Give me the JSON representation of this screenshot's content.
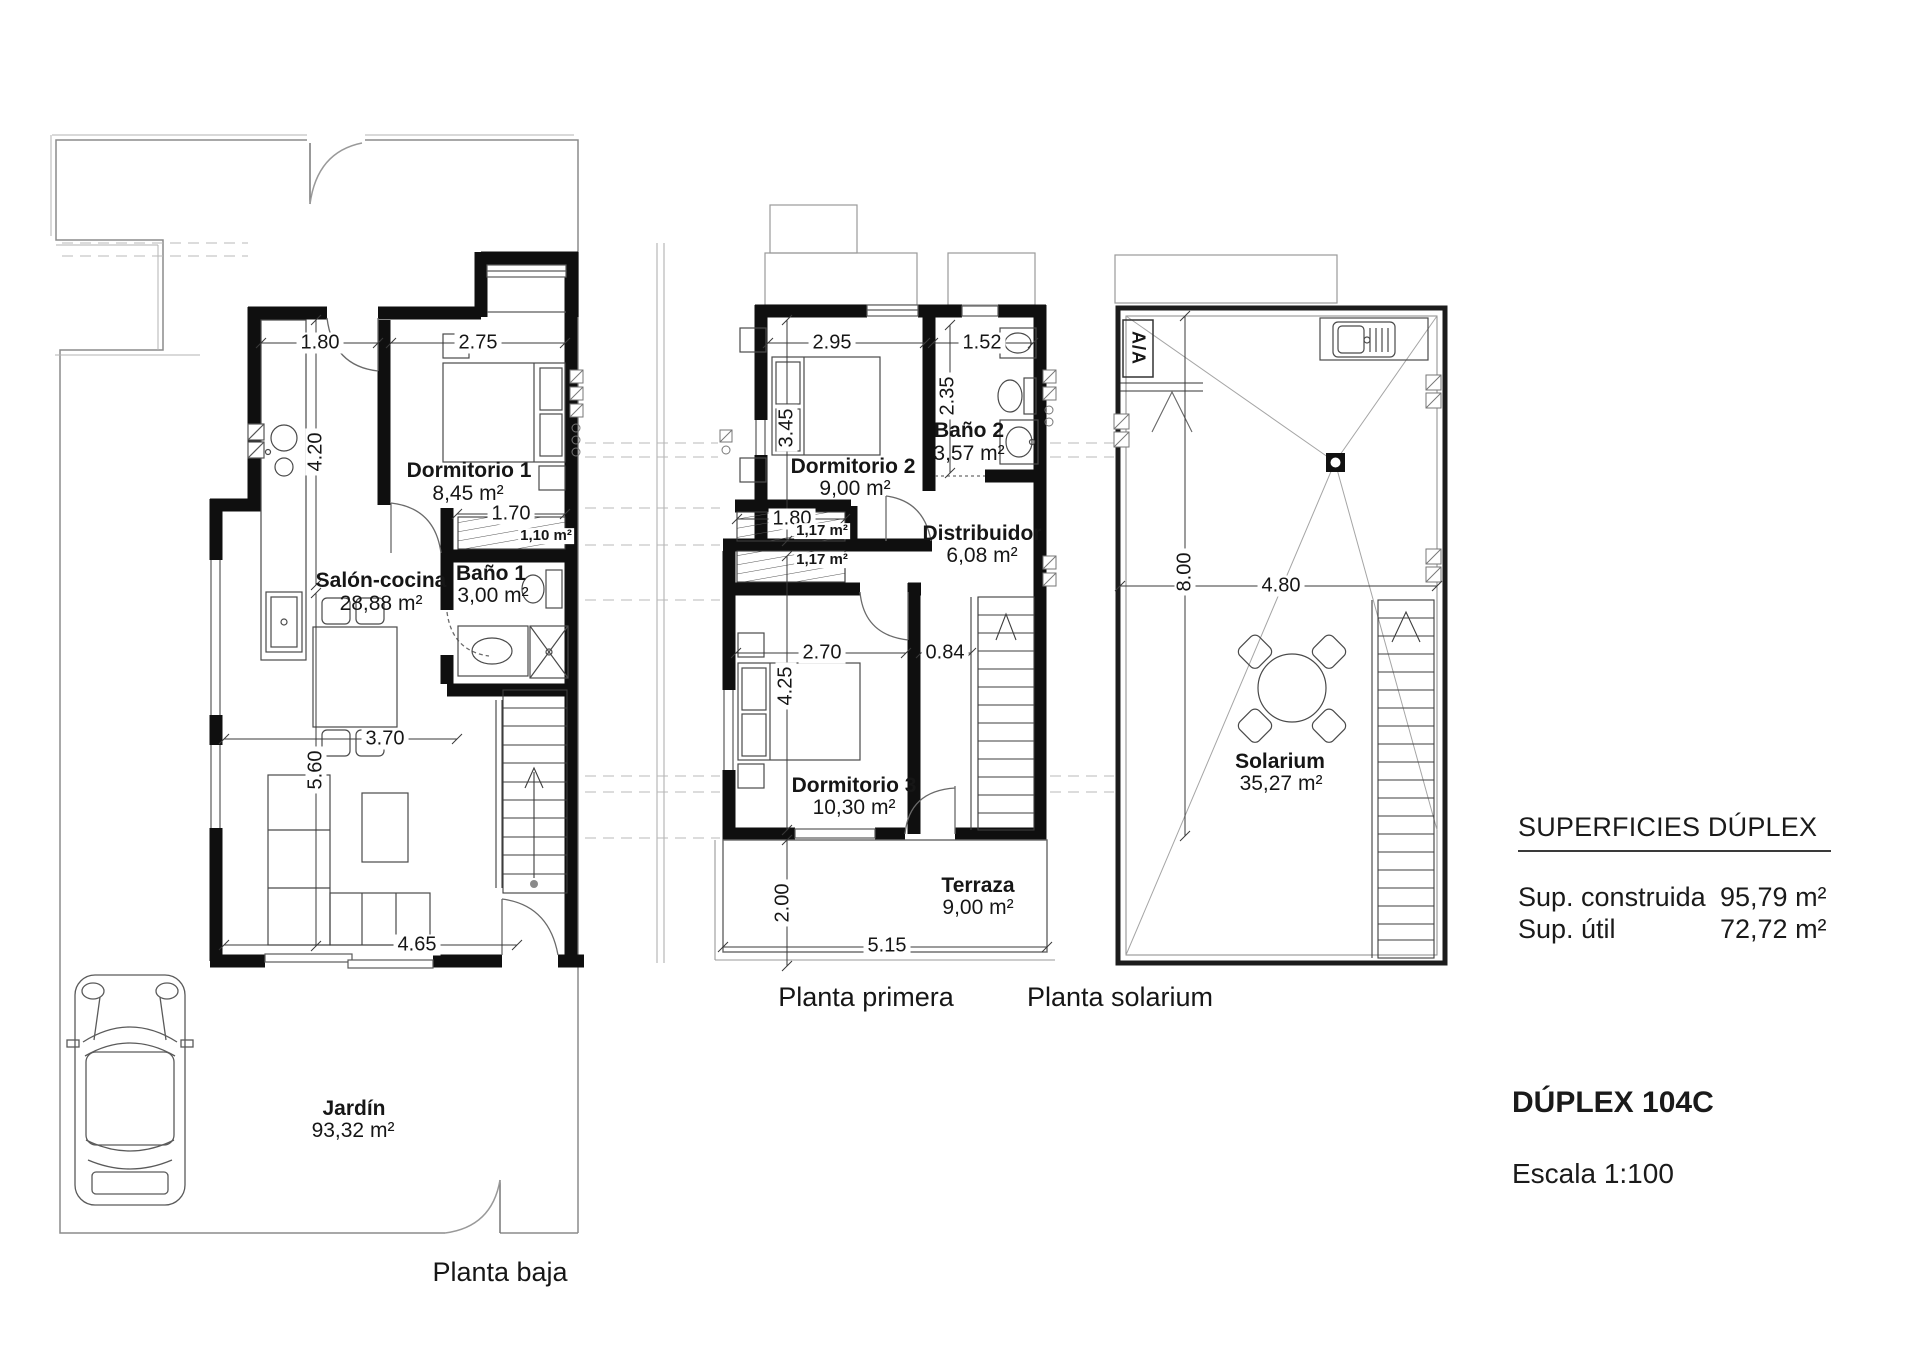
{
  "plans": {
    "baja": {
      "title": "Planta baja",
      "rooms": {
        "salon": {
          "name": "Salón-cocina",
          "area": "28,88 m²"
        },
        "dorm1": {
          "name": "Dormitorio 1",
          "area": "8,45 m²"
        },
        "bano1": {
          "name": "Baño 1",
          "area": "3,00 m²"
        },
        "escalera": {
          "area": "1,10 m²"
        },
        "jardin": {
          "name": "Jardín",
          "area": "93,32 m²"
        }
      },
      "dims": {
        "w_cocina": "1.80",
        "w_dorm1": "2.75",
        "h_cocina": "4.20",
        "w_escalera": "1.70",
        "w_salon": "3.70",
        "h_salon": "5.60",
        "w_salon_inf": "4.65"
      }
    },
    "primera": {
      "title": "Planta primera",
      "rooms": {
        "dorm2": {
          "name": "Dormitorio 2",
          "area": "9,00 m²"
        },
        "bano2": {
          "name": "Baño 2",
          "area": "3,57 m²"
        },
        "distribuidor": {
          "name": "Distribuidor",
          "area": "6,08 m²"
        },
        "dorm3": {
          "name": "Dormitorio 3",
          "area": "10,30 m²"
        },
        "terraza": {
          "name": "Terraza",
          "area": "9,00 m²"
        },
        "esc1": {
          "area": "1,17 m²"
        },
        "esc2": {
          "area": "1,17 m²"
        }
      },
      "dims": {
        "w_dorm2": "2.95",
        "w_bano2": "1.52",
        "h_dorm2": "3.45",
        "h_bano2": "2.35",
        "w_esc": "1.80",
        "w_dorm3": "2.70",
        "w_paso": "0.84",
        "h_dorm3": "4.25",
        "h_terraza": "2.00",
        "w_terraza": "5.15"
      }
    },
    "solarium": {
      "title": "Planta solarium",
      "rooms": {
        "solarium": {
          "name": "Solarium",
          "area": "35,27 m²"
        }
      },
      "labels": {
        "ac_unit": "A/A"
      },
      "dims": {
        "h_solarium": "8.00",
        "w_solarium": "4.80"
      }
    }
  },
  "summary": {
    "title": "SUPERFICIES DÚPLEX",
    "rows": [
      {
        "label": "Sup. construida",
        "value": "95,79 m²"
      },
      {
        "label": "Sup. útil",
        "value": "72,72 m²"
      }
    ],
    "unit_name": "DÚPLEX 104C",
    "scale": "Escala 1:100"
  }
}
